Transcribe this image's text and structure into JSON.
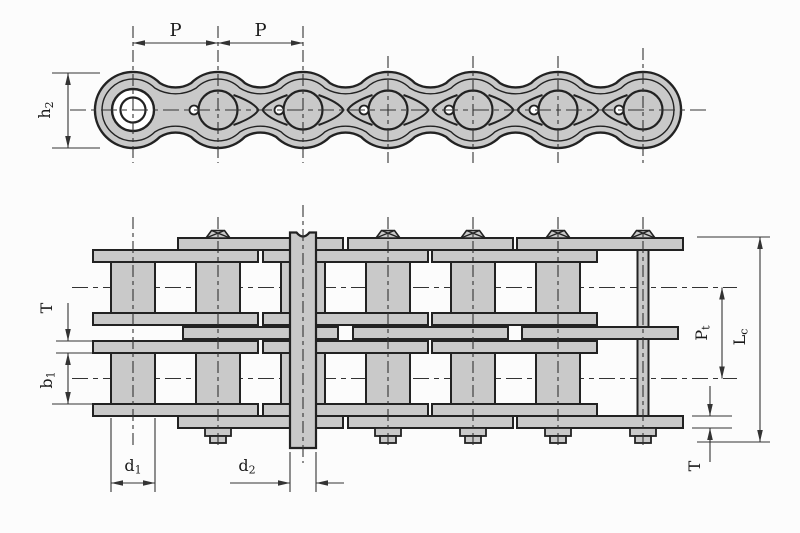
{
  "colors": {
    "background": "#fcfcfc",
    "chain_fill": "#c9c9c9",
    "outline": "#222222",
    "dim_line": "#333333",
    "text": "#1a1a1a"
  },
  "side_view": {
    "pitch_label_1": "P",
    "pitch_label_2": "P",
    "height_label": {
      "base": "h",
      "sub": "2"
    }
  },
  "plan_view": {
    "plate_thickness_left": "T",
    "inner_width": {
      "base": "b",
      "sub": "1"
    },
    "roller_diameter": {
      "base": "d",
      "sub": "1"
    },
    "pin_diameter": {
      "base": "d",
      "sub": "2"
    },
    "transverse_pitch": {
      "base": "P",
      "sub": "t"
    },
    "overall_width": {
      "base": "L",
      "sub": "c"
    },
    "plate_thickness_right": "T"
  }
}
